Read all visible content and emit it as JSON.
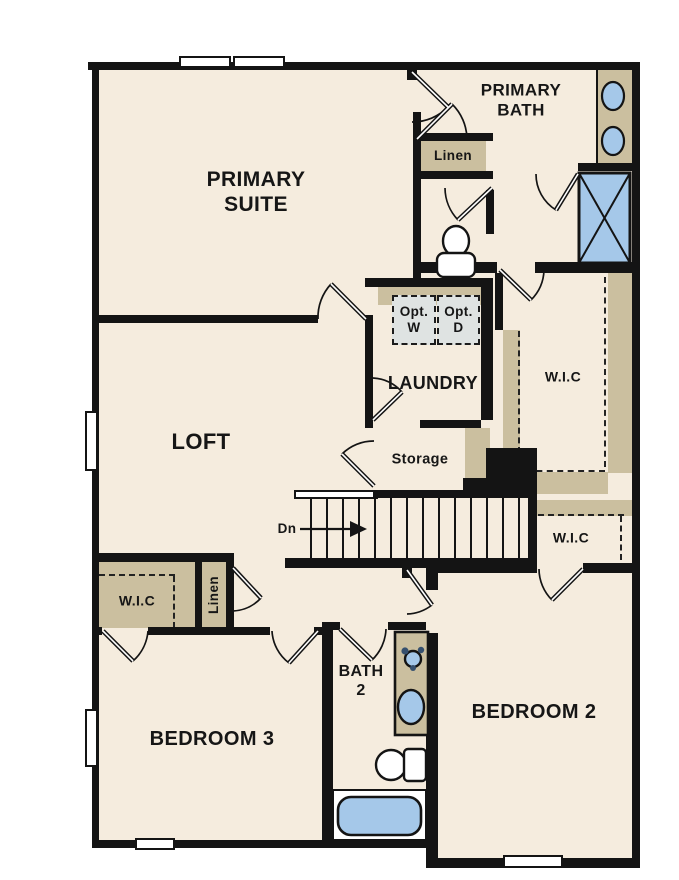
{
  "plan_title": "Second Floor Plan",
  "colors": {
    "floor": "#f5ecde",
    "wall": "#141414",
    "closet_tan": "#cbbf9f",
    "fixture_blue": "#a5c8e9",
    "appliance_gray": "#dfe3e2"
  },
  "labels": {
    "primary_suite": "PRIMARY\nSUITE",
    "primary_bath": "PRIMARY\nBATH",
    "linen_top": "Linen",
    "opt_w": "Opt.\nW",
    "opt_d": "Opt.\nD",
    "laundry": "LAUNDRY",
    "wic_right": "W.I.C",
    "loft": "LOFT",
    "storage": "Storage",
    "stairs_dn": "Dn",
    "wic_small": "W.I.C",
    "wic_left": "W.I.C",
    "linen_left": "Linen",
    "bedroom3": "BEDROOM 3",
    "bath2": "BATH\n2",
    "bedroom2": "BEDROOM 2"
  }
}
